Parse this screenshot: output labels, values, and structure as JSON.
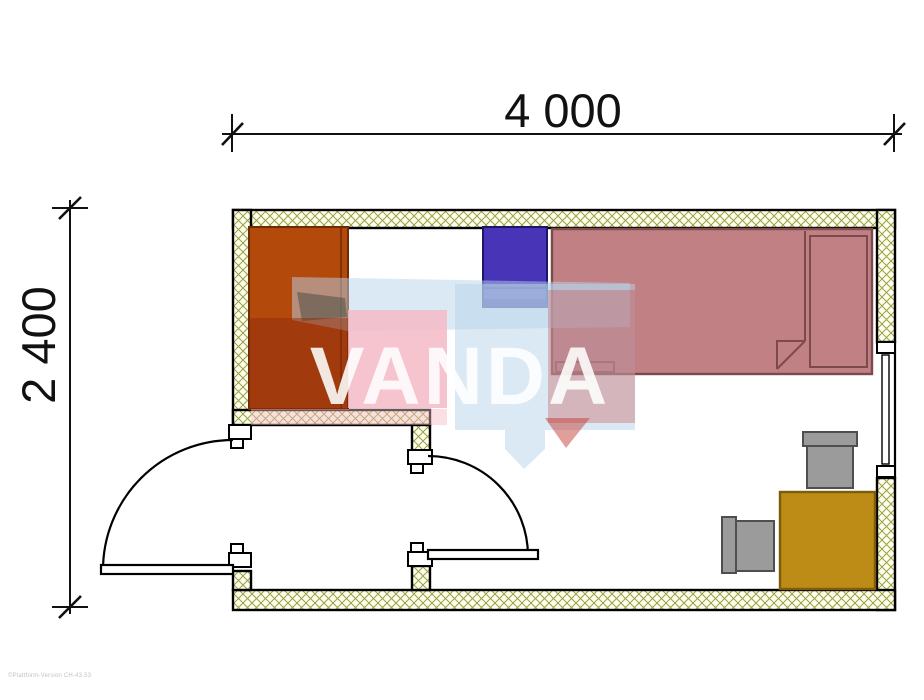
{
  "plan": {
    "type": "floor-plan",
    "watermark_text": "VANDA",
    "fine_print": "©Plattform-Version CH-43.53",
    "dimensions": {
      "width_label": "4 000",
      "height_label": "2 400"
    },
    "elements": [
      "wardrobe",
      "wall-cabinet",
      "single-bed-with-pillow-and-folded-blanket",
      "desk",
      "desk-chair-top",
      "desk-chair-left",
      "entry-vestibule",
      "exterior-door-swing-left",
      "interior-door-swing-right",
      "window-right-wall"
    ],
    "colors": {
      "wall_hatch": "#9aa23e",
      "wall_fill": "#fdfdf0",
      "outline": "#000000",
      "wardrobe": "#b4490c",
      "wardrobe_shade": "#8e2b0c",
      "cabinet": "#4734b6",
      "cabinet_base": "#2b2094",
      "bed": "#c18184",
      "bed_outline": "#7c4a4c",
      "desk": "#bd8c17",
      "desk_outline": "#7d5c0d",
      "chair": "#9b9b9b",
      "chair_outline": "#4f4f4f",
      "watermark_blue": "#b8d4ea",
      "watermark_pink": "#f5bac5",
      "watermark_red": "#c24038",
      "watermark_text_color": "#ffffff"
    }
  }
}
